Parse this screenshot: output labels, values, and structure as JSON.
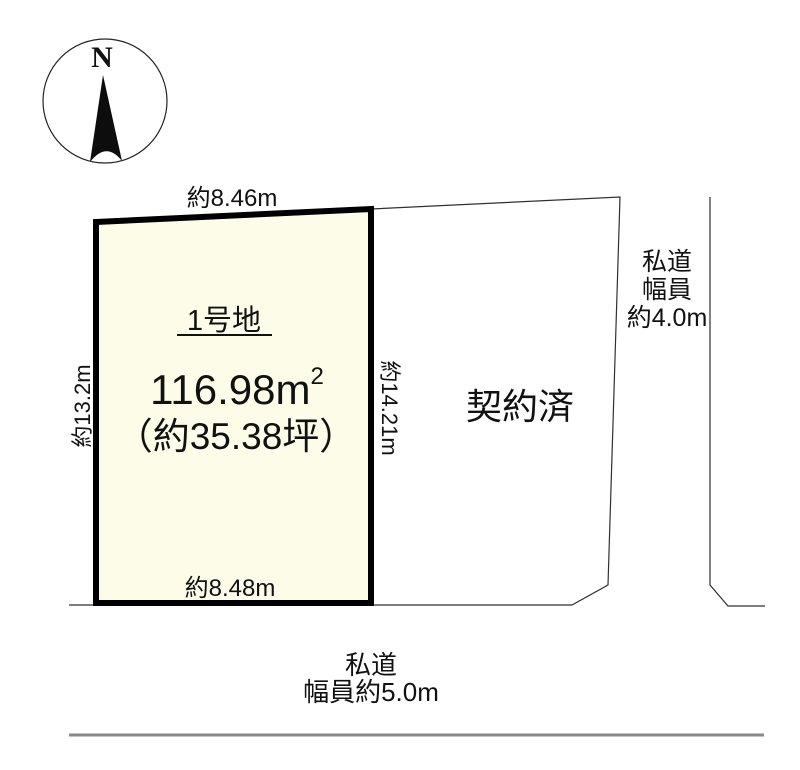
{
  "compass": {
    "north_label": "N"
  },
  "main_lot": {
    "name": "1号地",
    "area_m2": "116.98m",
    "area_m2_sup": "2",
    "area_tsubo": "（約35.38坪）",
    "dim_top": "約8.46m",
    "dim_bottom": "約8.48m",
    "dim_left": "約13.2m",
    "dim_right": "約14.21m"
  },
  "adjacent_lot": {
    "status_label": "契約済"
  },
  "right_road": {
    "label_lines": [
      "私道",
      "幅員",
      "約4.0m"
    ]
  },
  "bottom_road": {
    "label_lines": [
      "私道",
      "幅員約5.0m"
    ]
  },
  "colors": {
    "main_lot_fill": "#FCFCE8",
    "main_lot_outline": "#000000",
    "thin_line": "#303030",
    "road_edge_gray": "#8a8a8a"
  }
}
